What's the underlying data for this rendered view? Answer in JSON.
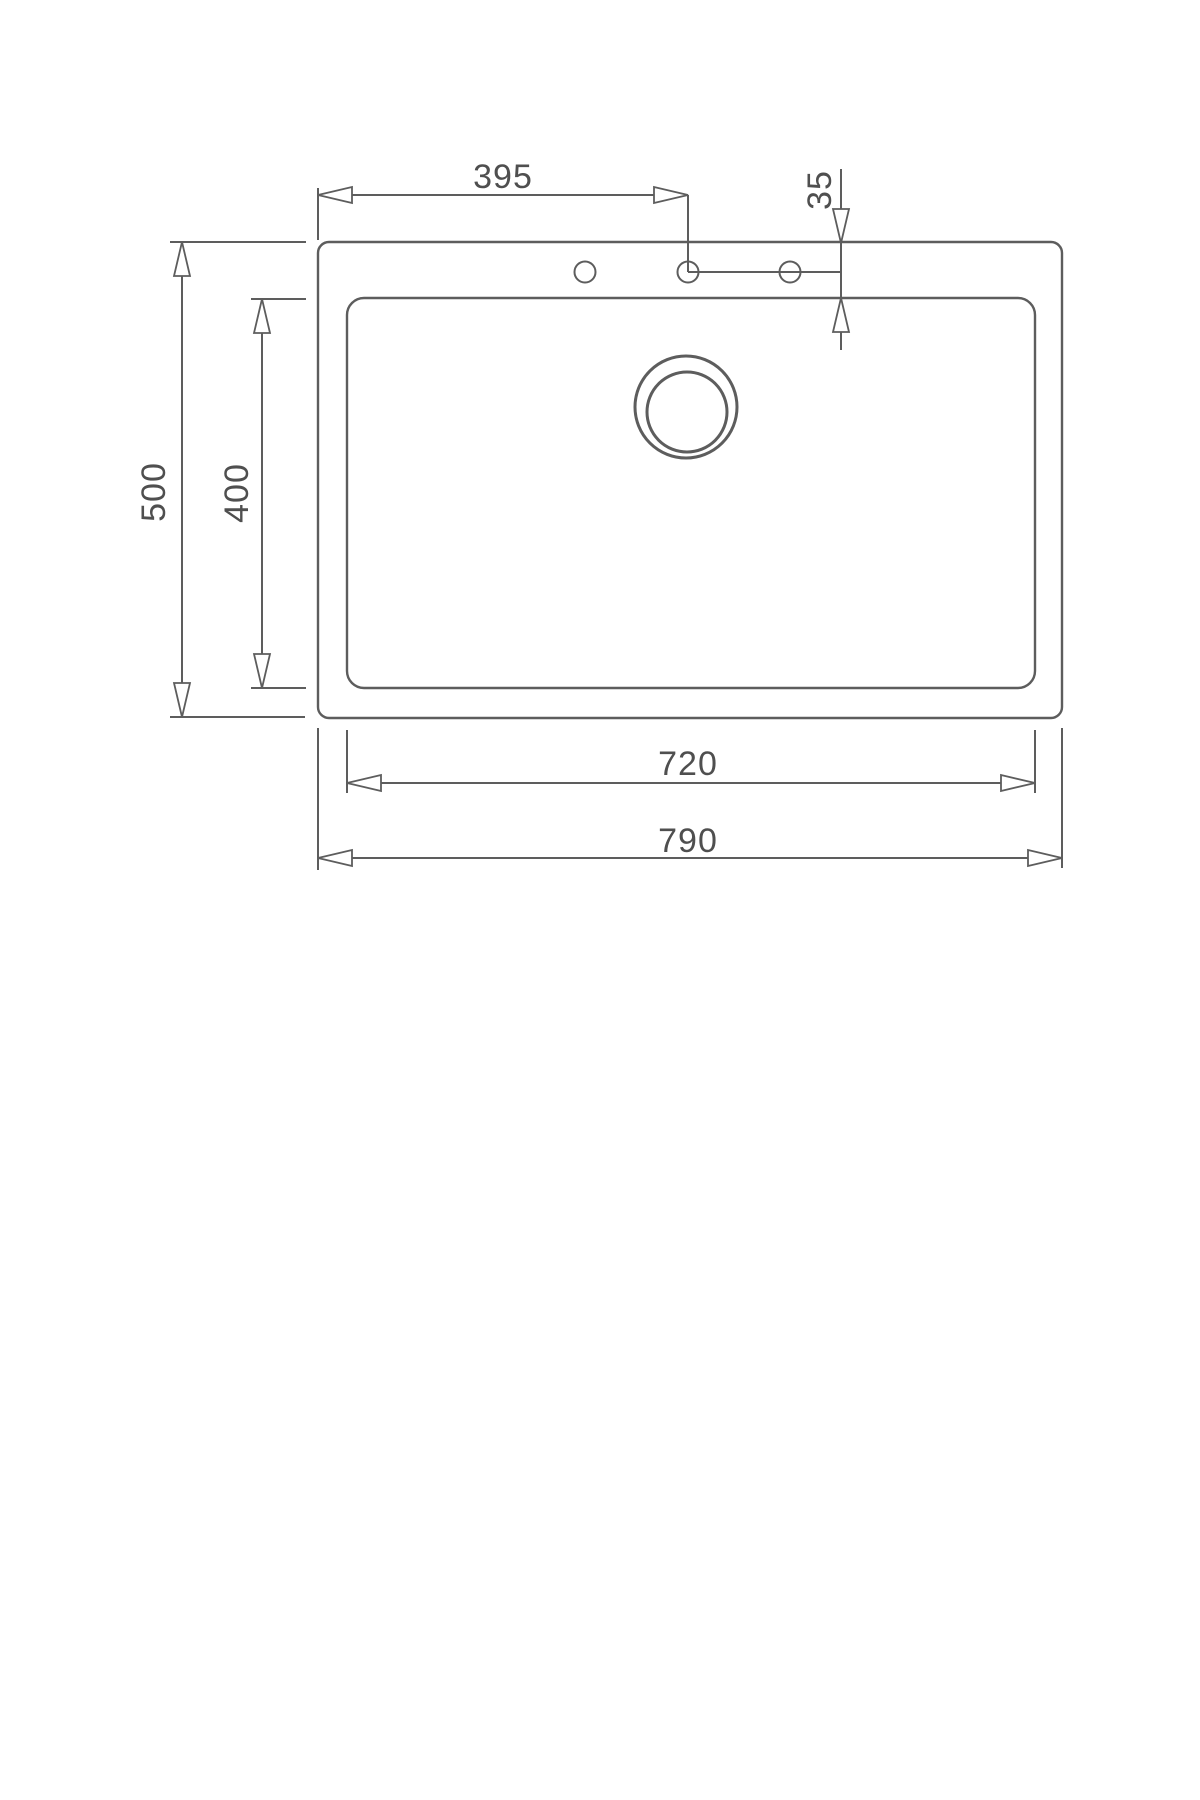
{
  "drawing": {
    "name": "sink-top-view-technical-drawing",
    "dimensions": {
      "top_left_edge_to_center_hole": "395",
      "hole_offset": "35",
      "outer_depth": "500",
      "bowl_depth": "400",
      "bowl_width": "720",
      "outer_width": "790"
    },
    "colors": {
      "line": "#5d5d5d",
      "text": "#4f4f4f",
      "background": "#ffffff"
    }
  }
}
